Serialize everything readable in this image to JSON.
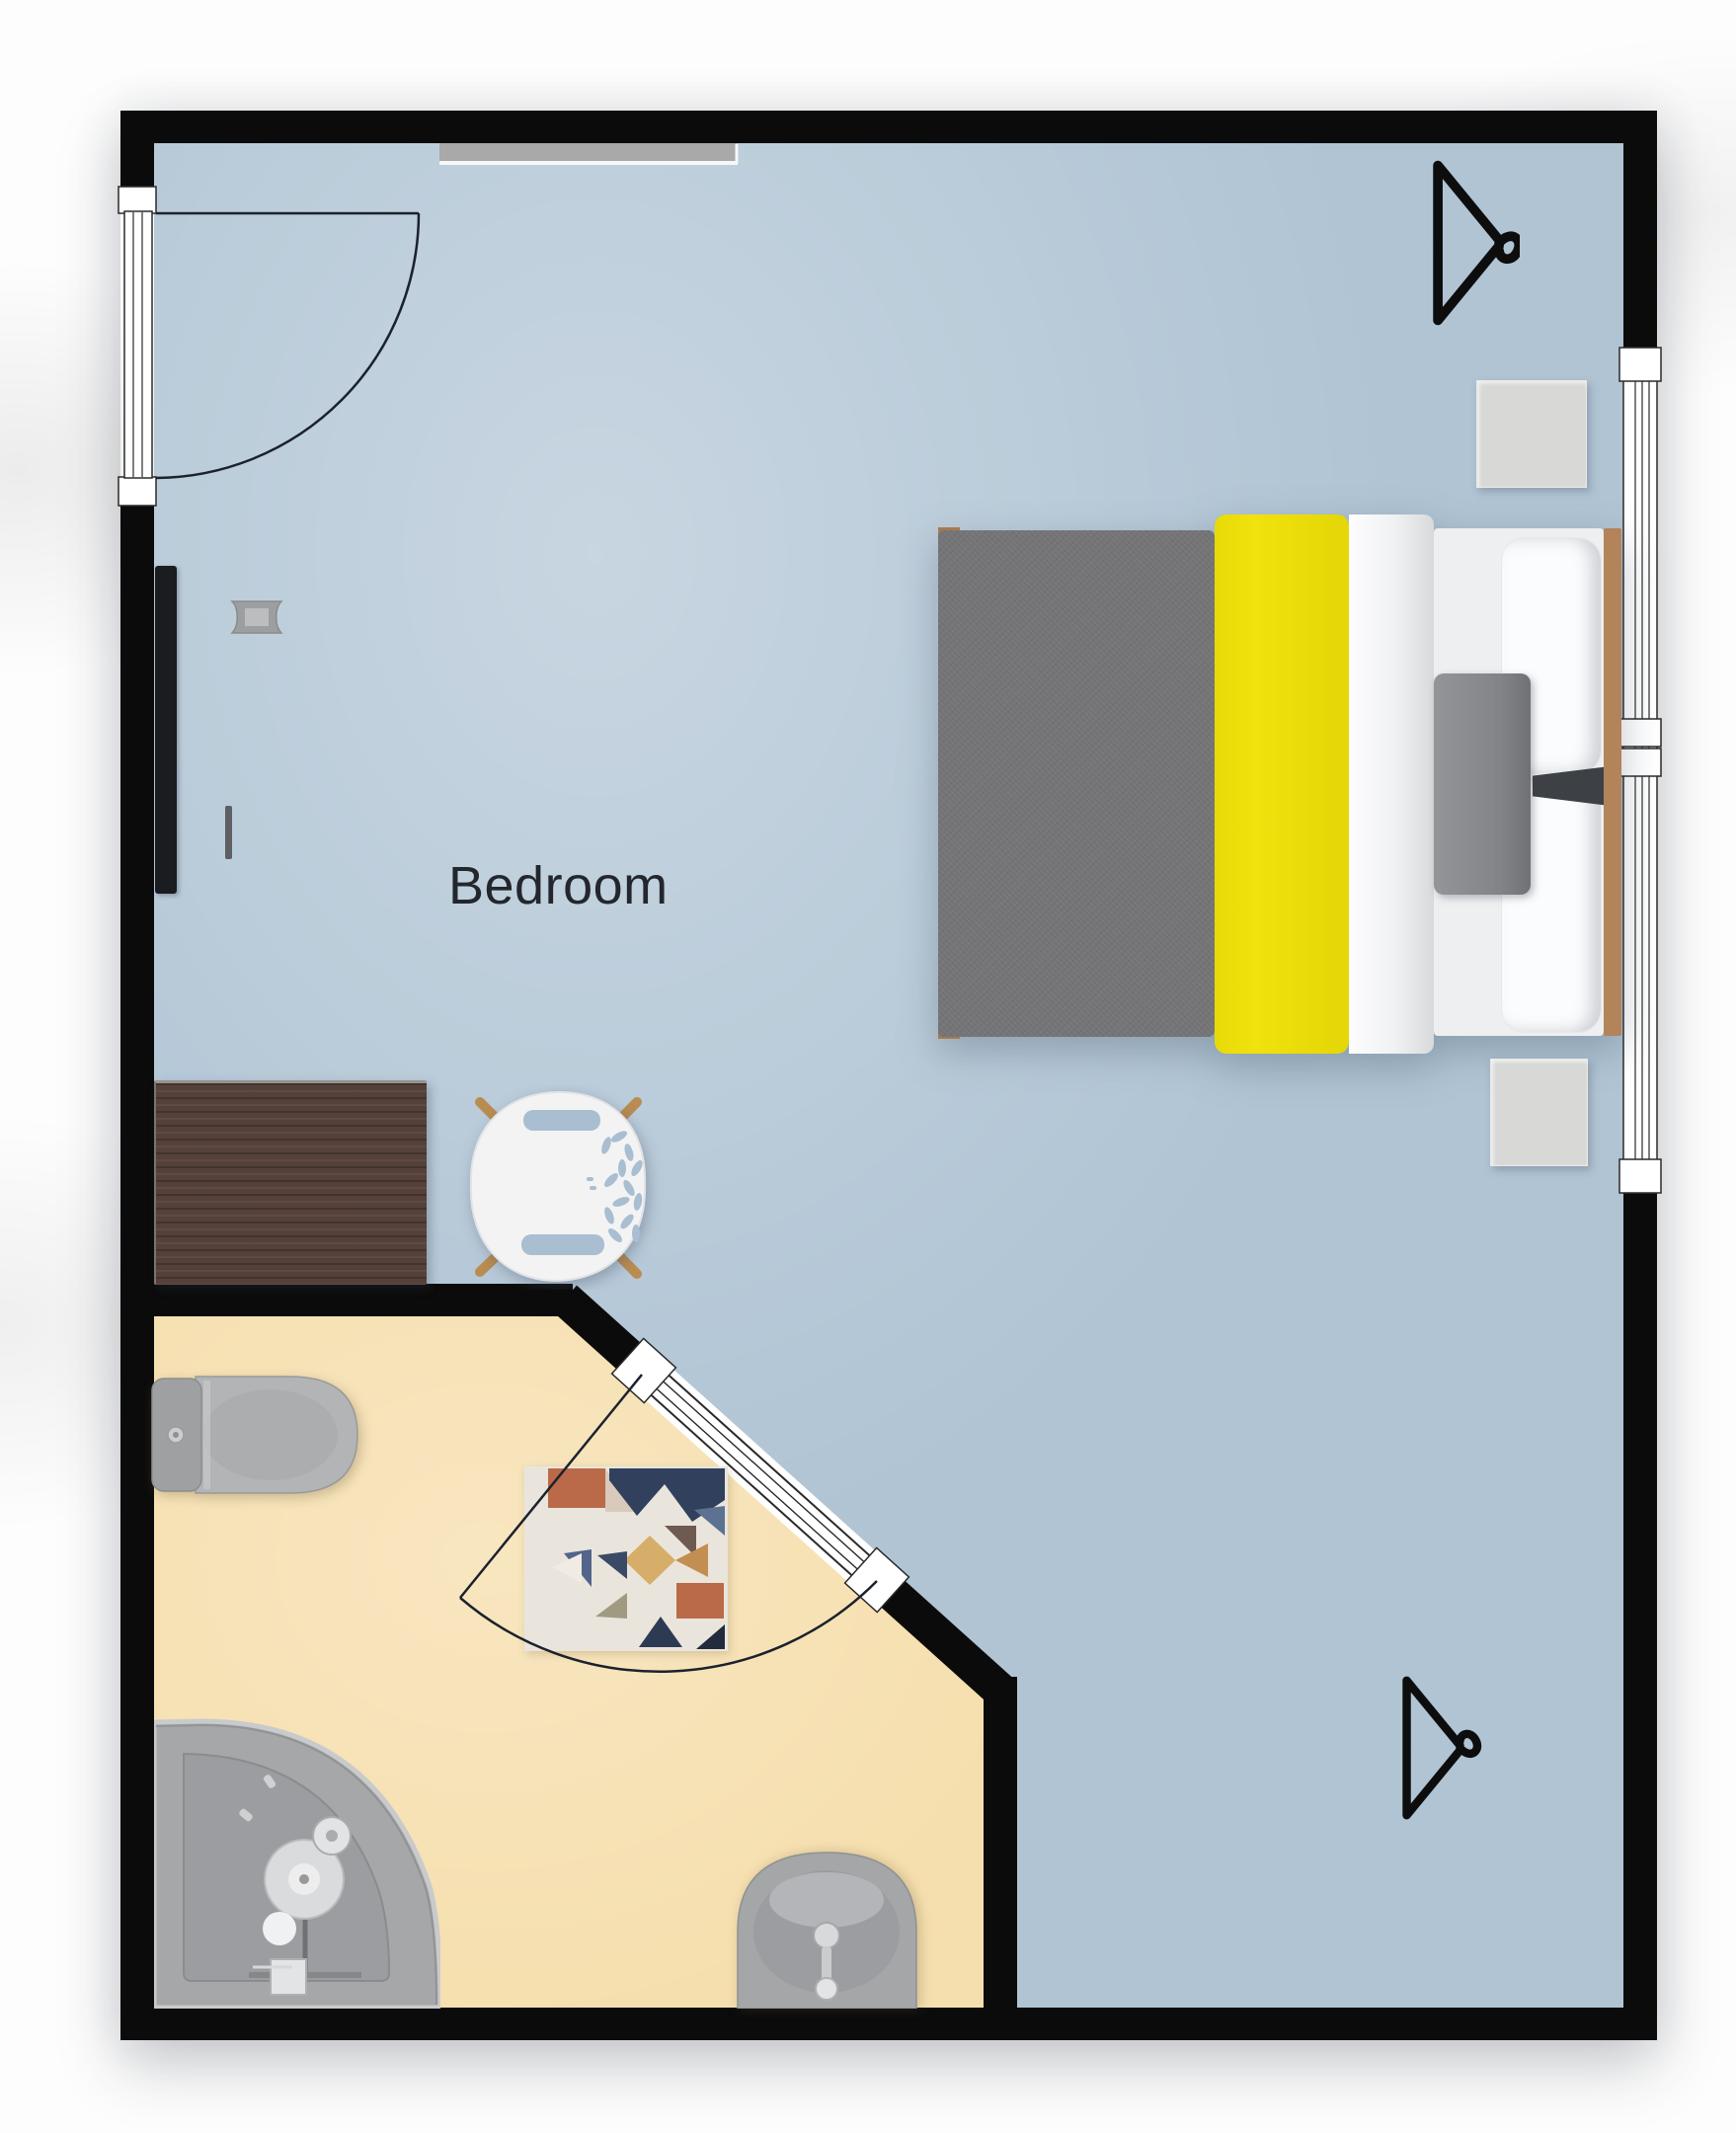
{
  "room": {
    "label": "Bedroom"
  },
  "theme": {
    "colors": {
      "wall": "#0b0b0b",
      "bedroom_floor": "#b0c4d4",
      "bathroom_floor": "#f6dfae",
      "accent_yellow": "#f0e20c",
      "blanket_gray": "#747476",
      "duvet_white": "#f5f6f8",
      "headboard_wood": "#b3835a",
      "desk_wood": "#56413a",
      "chair_white": "#f3f3f4",
      "chair_leg_wood": "#b98c52",
      "fixture_gray": "#aaacae",
      "nightstand_gray": "#d8d8d6",
      "rug_base": "#eae5dc",
      "rug_rust": "#ba6a48",
      "rug_navy": "#31405c",
      "rug_tan": "#d6ae69",
      "swing_line": "#1b222c",
      "label_text": "#23272d"
    }
  },
  "objects": {
    "rooms": [
      "bedroom",
      "bathroom"
    ],
    "furniture": [
      "bed",
      "nightstand-top",
      "nightstand-bottom",
      "desk",
      "desk-chair",
      "tv",
      "wall-light",
      "light-switch",
      "wardrobe-rail",
      "rug",
      "toilet",
      "shower",
      "sink"
    ],
    "openings": [
      "entry-door",
      "bathroom-door",
      "right-window"
    ],
    "icons": [
      "hanger-icon-top",
      "hanger-icon-bottom"
    ]
  }
}
